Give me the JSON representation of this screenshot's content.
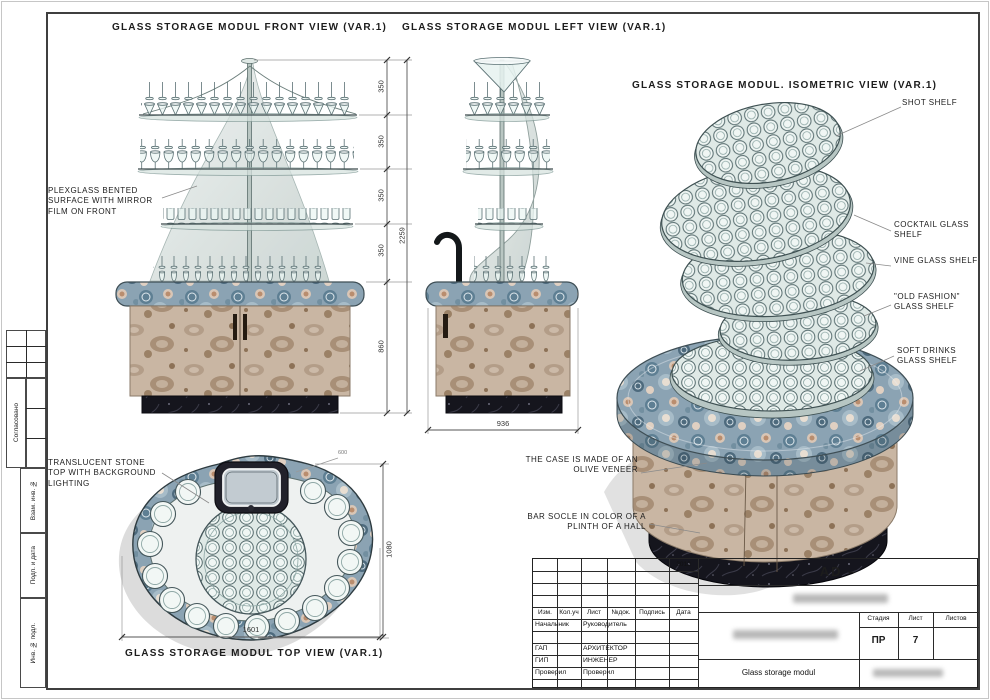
{
  "sheet": {
    "titles": {
      "front": "GLASS STORAGE MODUL FRONT VIEW (VAR.1)",
      "left": "GLASS STORAGE MODUL LEFT VIEW (VAR.1)",
      "iso": "GLASS STORAGE MODUL. ISOMETRIC VIEW (VAR.1)",
      "top": "GLASS STORAGE MODUL TOP VIEW (VAR.1)"
    },
    "annotations": {
      "plexiglass": "PLEXGLASS BENTED SURFACE WITH MIRROR FILM ON FRONT",
      "translucent": "TRANSLUCENT STONE TOP WITH BACKGROUND LIGHTING",
      "shot": "SHOT SHELF",
      "cocktail": "COCKTAIL GLASS SHELF",
      "vine": "VINE GLASS SHELF",
      "old_fashion": "\"OLD FASHION\" GLASS SHELF",
      "soft_drinks": "SOFT DRINKS GLASS SHELF",
      "case": "THE CASE IS MADE OF AN OLIVE VENEER",
      "socle": "BAR SOCLE IN COLOR OF A PLINTH OF A HALL"
    },
    "dimensions": {
      "front_segments": [
        "350",
        "350",
        "350",
        "350"
      ],
      "front_cabinet": "860",
      "front_total": "2259",
      "left_width": "936",
      "top_width": "1601",
      "top_depth": "1080",
      "top_small": "600"
    },
    "stamps": {
      "approved": "Согласовано",
      "replacement": "Взам. инв. №",
      "sign_date": "Подп. и дата",
      "inventory": "Инв. № подл."
    },
    "title_block": {
      "year": "2012",
      "project_code": "AD –",
      "columns": [
        "Изм.",
        "Кол.уч",
        "Лист",
        "№док.",
        "Подпись",
        "Дата"
      ],
      "roles": [
        {
          "left": "Начальник",
          "right": "Руководитель"
        },
        {
          "left": "ГАП",
          "right": "АРХИТЕКТОР"
        },
        {
          "left": "ГИП",
          "right": "ИНЖЕНЕР"
        },
        {
          "left": "Проверил",
          "right": "Проверил"
        }
      ],
      "stage_label": "Стадия",
      "sheet_label": "Лист",
      "sheets_label": "Листов",
      "stage_value": "ПР",
      "sheet_value": "7",
      "doc_title": "Glass storage modul"
    },
    "colors": {
      "agate_stone": "#8ba3b3",
      "olive_veneer": "#c9b6a3",
      "plinth_black": "#17171f",
      "glass": "#eef4f2"
    }
  }
}
